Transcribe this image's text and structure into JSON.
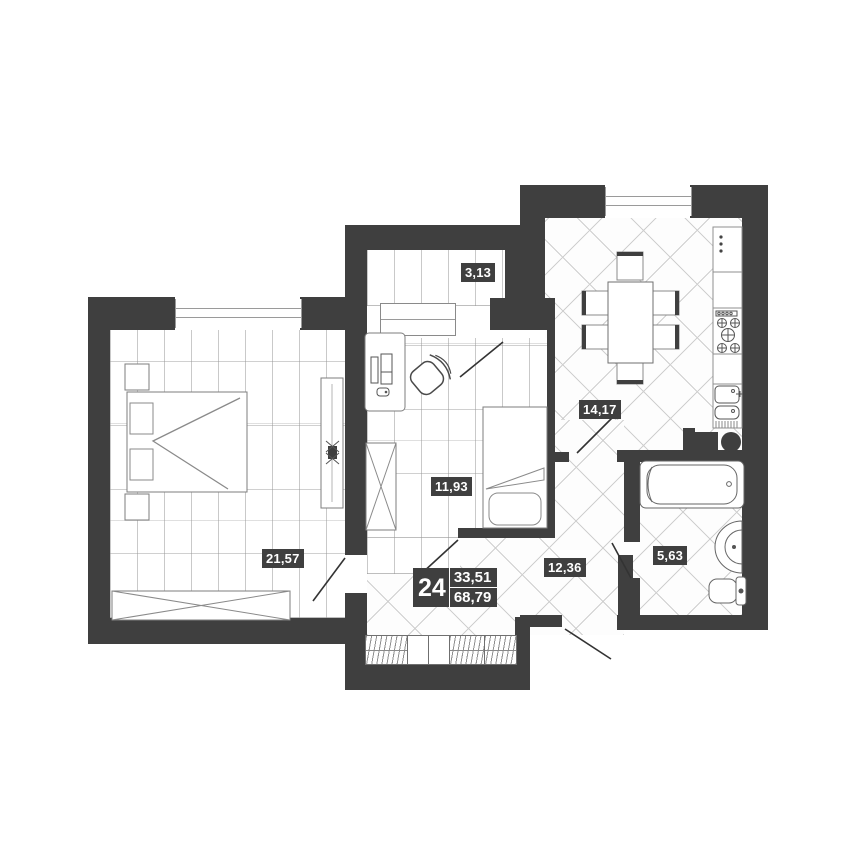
{
  "plan": {
    "type": "apartment-floor-plan",
    "unit": {
      "number": "24",
      "living_area": "33,51",
      "total_area": "68,79"
    },
    "rooms": {
      "bedroom": {
        "area": "21,57"
      },
      "room2": {
        "area": "11,93"
      },
      "balcony": {
        "area": "3,13"
      },
      "kitchen": {
        "area": "14,17"
      },
      "hallway": {
        "area": "12,36"
      },
      "bathroom": {
        "area": "5,63"
      }
    },
    "colors": {
      "wall": "#3f3f3f",
      "badge_bg": "#3f3f3f",
      "badge_text": "#ffffff",
      "floor_line": "#c9c9c9"
    }
  }
}
